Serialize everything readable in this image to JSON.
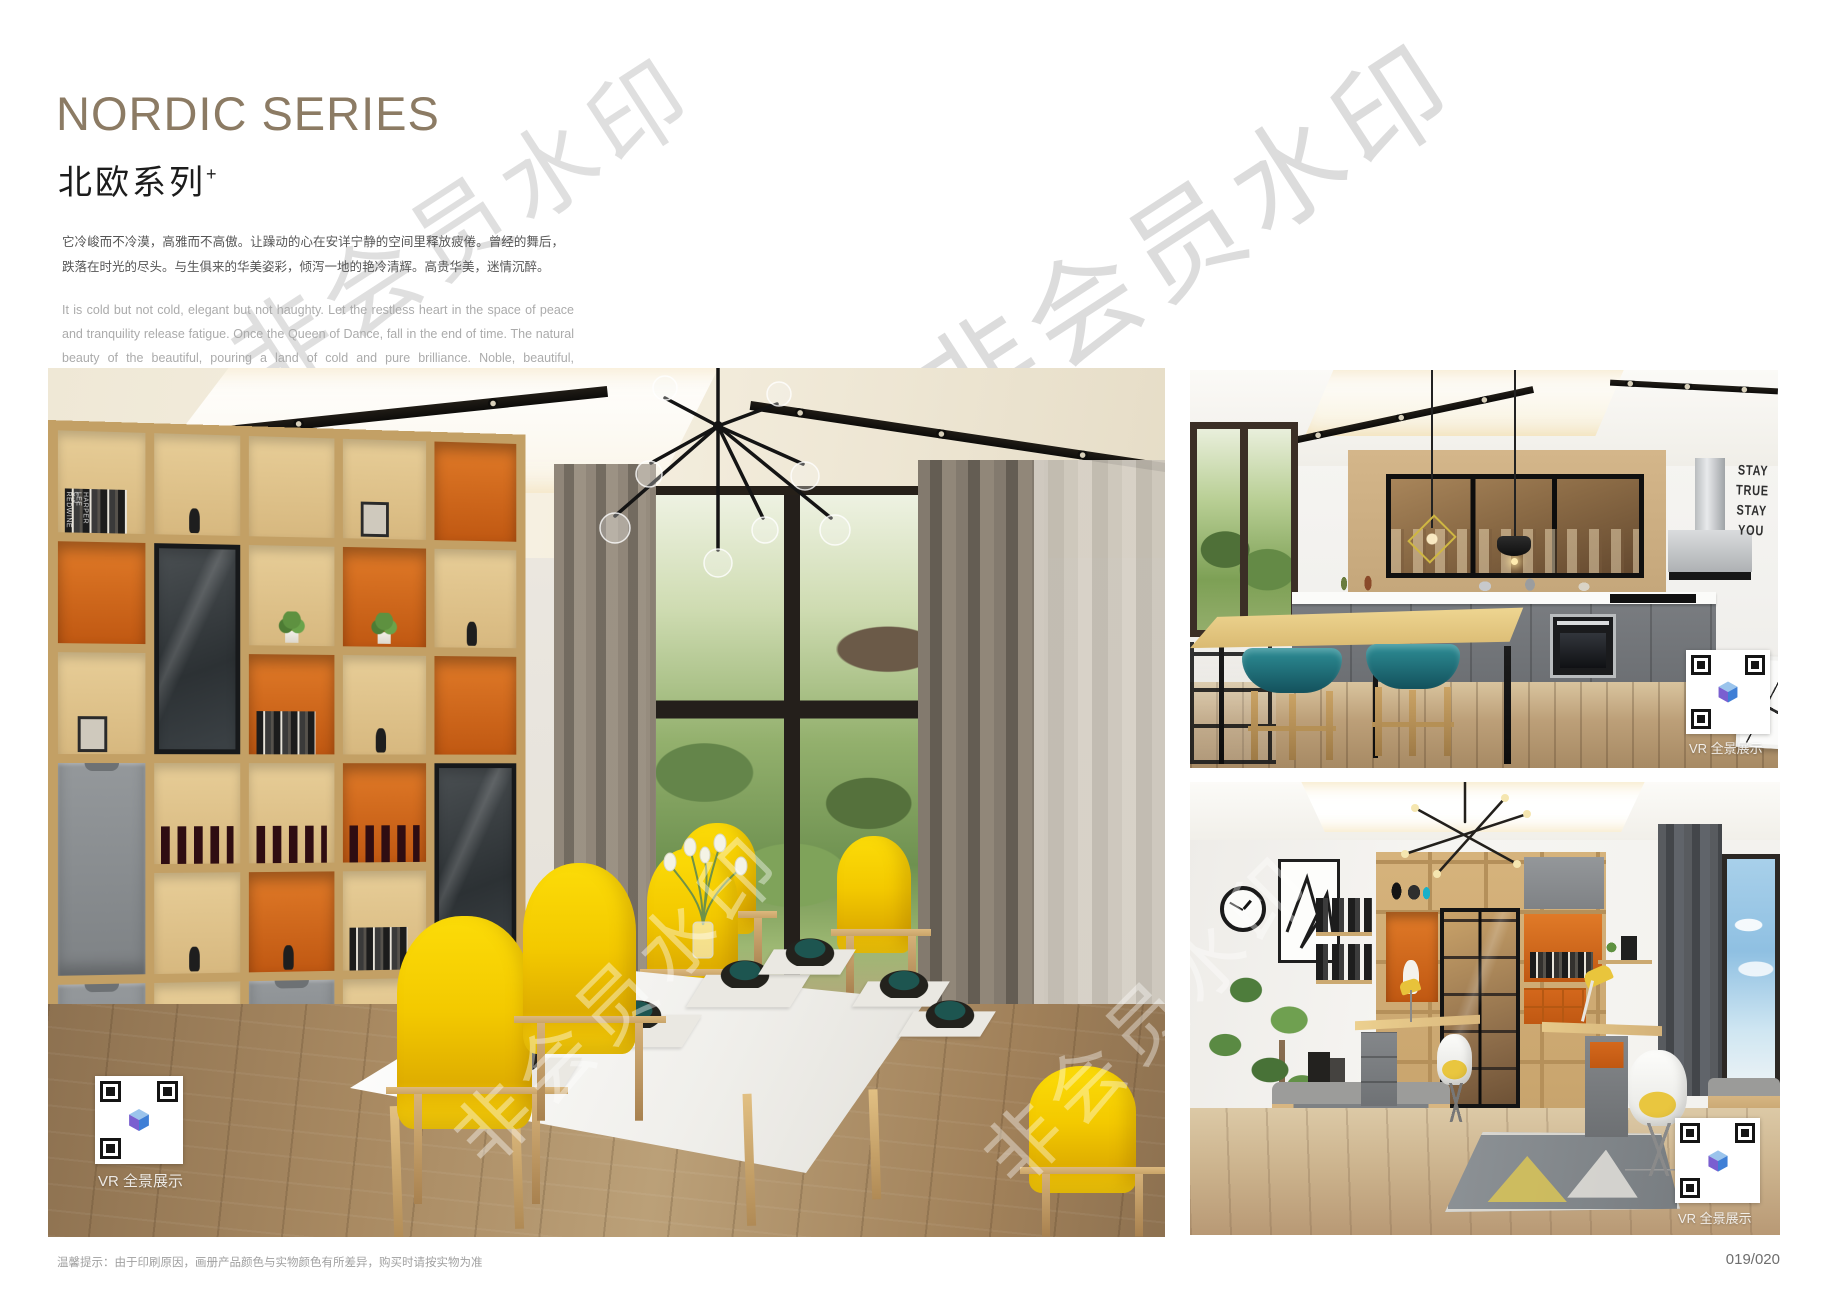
{
  "header": {
    "title": "NORDIC SERIES",
    "subtitle": "北欧系列",
    "subtitle_superscript": "+",
    "paragraph_cn": "它冷峻而不冷漠，高雅而不高傲。让躁动的心在安详宁静的空间里释放疲倦。曾经的舞后，跌落在时光的尽头。与生俱来的华美姿彩，倾泻一地的艳冷清辉。高贵华美，迷情沉醉。",
    "paragraph_en": "It is cold but not cold, elegant but not haughty. Let the restless heart in the space of peace and tranquility release fatigue. Once the Queen of Dance, fall in the end of time. The natural beauty of the beautiful, pouring a land of cold and pure brilliance. Noble, beautiful, enchanted."
  },
  "watermark": {
    "text": "非会员水印"
  },
  "photos": {
    "vr_badge_label": "VR 全景展示",
    "dining": {
      "book_spines": [
        "C.J REDWINE",
        "HARPER LEE"
      ]
    },
    "kitchen": {
      "wall_sign": [
        "STAY",
        "TRUE",
        "STAY",
        "YOU"
      ]
    }
  },
  "footer": {
    "note": "温馨提示：由于印刷原因，画册产品颜色与实物颜色有所差异，购买时请按实物为准",
    "page_number": "019/020"
  },
  "colors": {
    "title_bronze": "#8C7B64",
    "accent_orange": "#D4681C",
    "accent_yellow": "#F6CE00",
    "accent_teal": "#1D6E78",
    "wood": "#D8B57C",
    "cabinet_gray": "#888C90"
  }
}
